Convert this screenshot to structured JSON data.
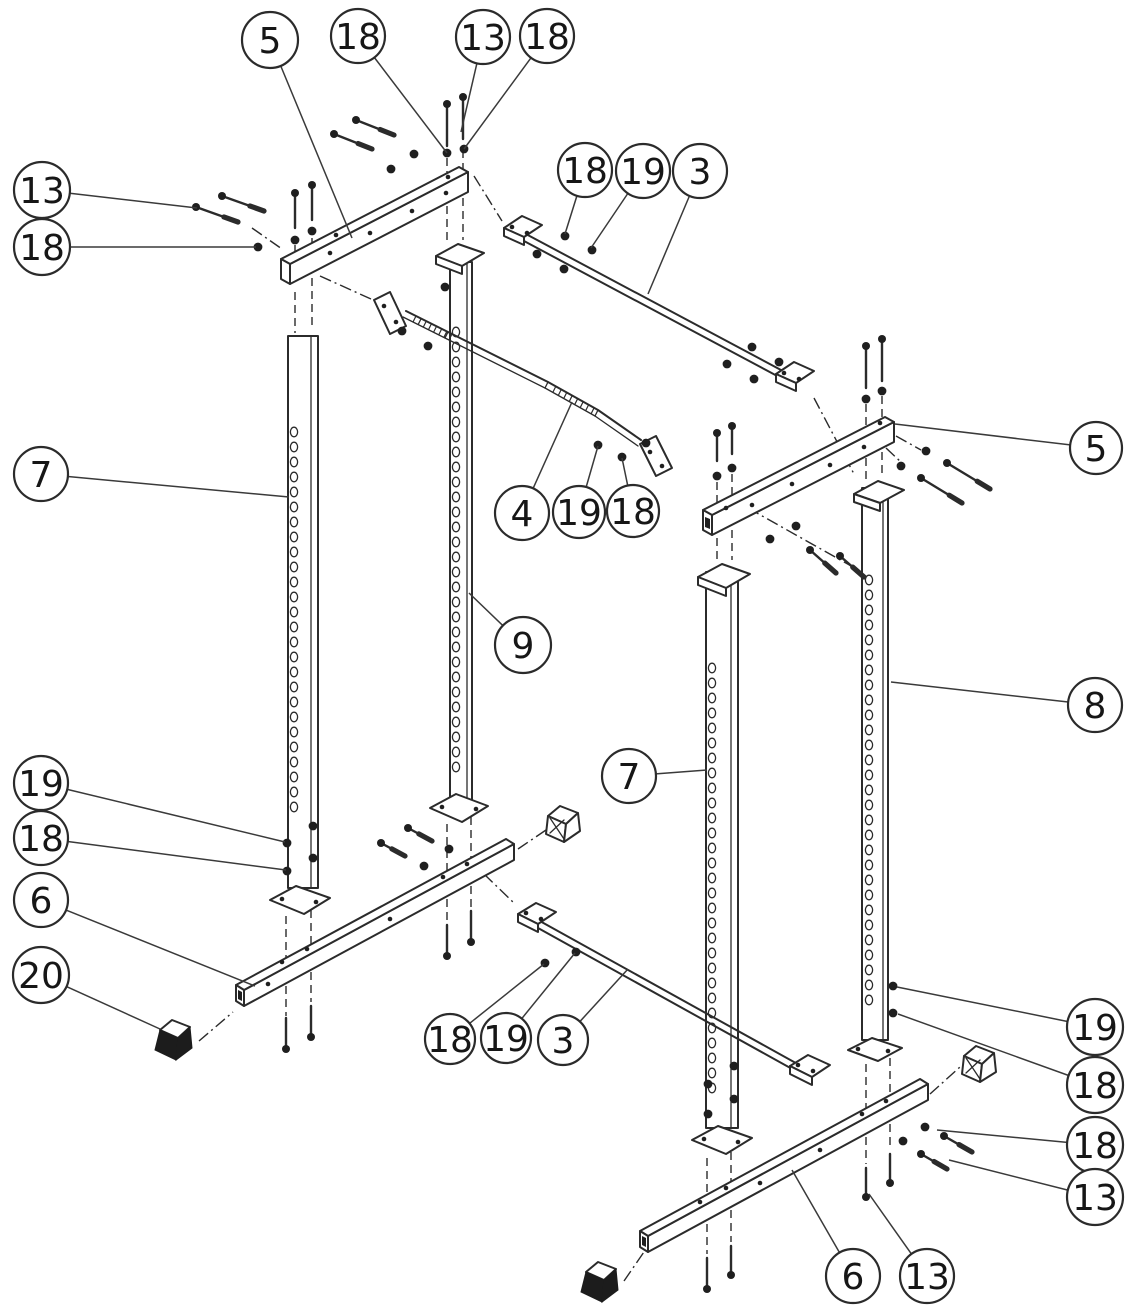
{
  "figure": {
    "type": "exploded-assembly-diagram",
    "subject": "power rack frame exploded view",
    "background_color": "#ffffff",
    "line_color": "#2b2b2b",
    "part_numbers_visible": [
      "3",
      "4",
      "5",
      "6",
      "7",
      "8",
      "9",
      "13",
      "18",
      "19",
      "20"
    ]
  },
  "callouts": [
    {
      "label": "5",
      "cx": 270,
      "cy": 40,
      "r": 28,
      "tx": 352,
      "ty": 238
    },
    {
      "label": "18",
      "cx": 358,
      "cy": 36,
      "r": 27,
      "tx": 447,
      "ty": 153
    },
    {
      "label": "13",
      "cx": 483,
      "cy": 37,
      "r": 27,
      "tx": 461,
      "ty": 132
    },
    {
      "label": "18",
      "cx": 547,
      "cy": 36,
      "r": 27,
      "tx": 464,
      "ty": 149
    },
    {
      "label": "18",
      "cx": 585,
      "cy": 170,
      "r": 27,
      "tx": 565,
      "ty": 234
    },
    {
      "label": "19",
      "cx": 643,
      "cy": 171,
      "r": 27,
      "tx": 591,
      "ty": 248
    },
    {
      "label": "3",
      "cx": 700,
      "cy": 171,
      "r": 27,
      "tx": 648,
      "ty": 294
    },
    {
      "label": "13",
      "cx": 42,
      "cy": 190,
      "r": 28,
      "tx": 197,
      "ty": 208
    },
    {
      "label": "18",
      "cx": 42,
      "cy": 247,
      "r": 28,
      "tx": 256,
      "ty": 247
    },
    {
      "label": "5",
      "cx": 1096,
      "cy": 448,
      "r": 26,
      "tx": 895,
      "ty": 424
    },
    {
      "label": "7",
      "cx": 41,
      "cy": 474,
      "r": 27,
      "tx": 289,
      "ty": 497
    },
    {
      "label": "4",
      "cx": 522,
      "cy": 513,
      "r": 27,
      "tx": 572,
      "ty": 402
    },
    {
      "label": "19",
      "cx": 579,
      "cy": 512,
      "r": 26,
      "tx": 598,
      "ty": 446
    },
    {
      "label": "18",
      "cx": 633,
      "cy": 511,
      "r": 26,
      "tx": 622,
      "ty": 458
    },
    {
      "label": "9",
      "cx": 523,
      "cy": 645,
      "r": 28,
      "tx": 469,
      "ty": 593
    },
    {
      "label": "8",
      "cx": 1095,
      "cy": 705,
      "r": 27,
      "tx": 891,
      "ty": 682
    },
    {
      "label": "7",
      "cx": 629,
      "cy": 776,
      "r": 27,
      "tx": 707,
      "ty": 770
    },
    {
      "label": "19",
      "cx": 41,
      "cy": 783,
      "r": 27,
      "tx": 285,
      "ty": 842
    },
    {
      "label": "18",
      "cx": 41,
      "cy": 838,
      "r": 27,
      "tx": 286,
      "ty": 870
    },
    {
      "label": "6",
      "cx": 41,
      "cy": 900,
      "r": 27,
      "tx": 255,
      "ty": 986
    },
    {
      "label": "20",
      "cx": 41,
      "cy": 975,
      "r": 28,
      "tx": 160,
      "ty": 1029
    },
    {
      "label": "18",
      "cx": 450,
      "cy": 1039,
      "r": 25,
      "tx": 544,
      "ty": 964
    },
    {
      "label": "19",
      "cx": 506,
      "cy": 1038,
      "r": 25,
      "tx": 575,
      "ty": 953
    },
    {
      "label": "3",
      "cx": 563,
      "cy": 1040,
      "r": 25,
      "tx": 628,
      "ty": 969
    },
    {
      "label": "19",
      "cx": 1095,
      "cy": 1027,
      "r": 28,
      "tx": 897,
      "ty": 987
    },
    {
      "label": "18",
      "cx": 1095,
      "cy": 1085,
      "r": 28,
      "tx": 898,
      "ty": 1014
    },
    {
      "label": "18",
      "cx": 1095,
      "cy": 1145,
      "r": 28,
      "tx": 937,
      "ty": 1130
    },
    {
      "label": "13",
      "cx": 1095,
      "cy": 1197,
      "r": 28,
      "tx": 949,
      "ty": 1160
    },
    {
      "label": "6",
      "cx": 853,
      "cy": 1276,
      "r": 27,
      "tx": 792,
      "ty": 1170
    },
    {
      "label": "13",
      "cx": 927,
      "cy": 1276,
      "r": 27,
      "tx": 869,
      "ty": 1194
    }
  ]
}
